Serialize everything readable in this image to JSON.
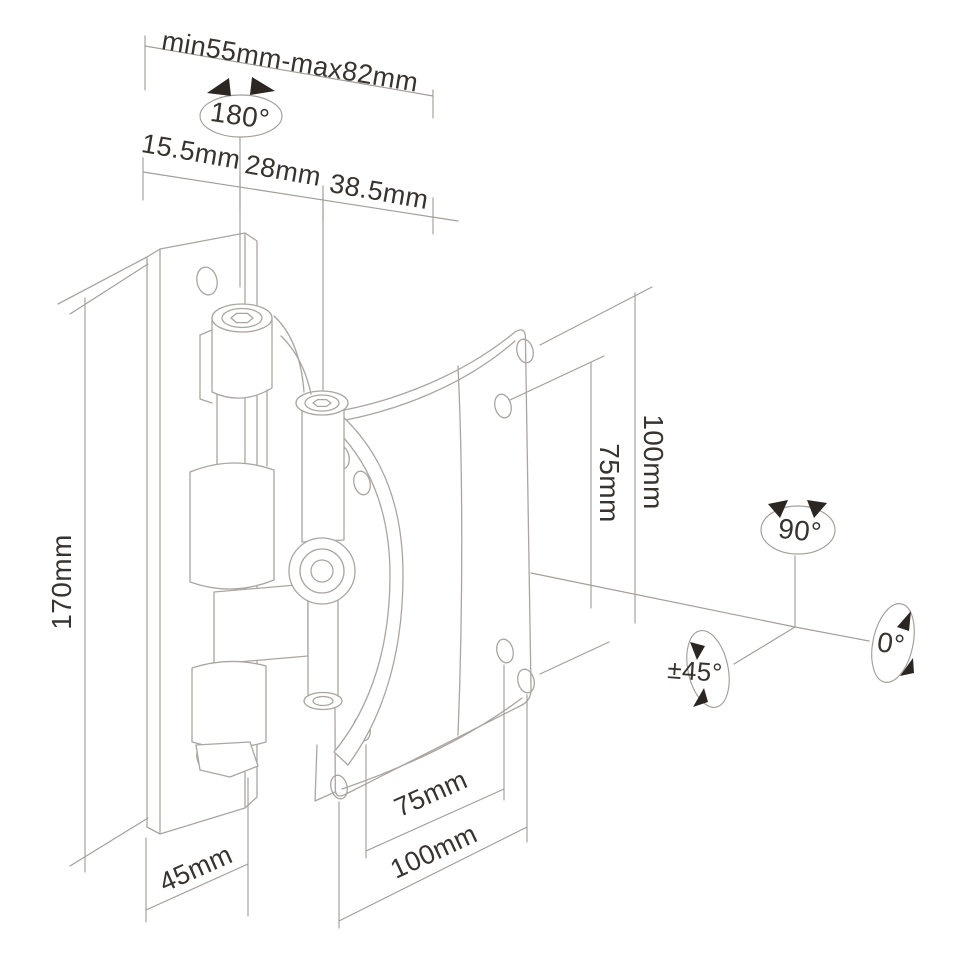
{
  "page": {
    "background": "#ffffff"
  },
  "diagram": {
    "subject": "wall-mount monitor bracket technical drawing with dimensions",
    "colors": {
      "object_line": "#aba59f",
      "dimension_line": "#a49e98",
      "text": "#38332e",
      "arrow": "#2b2621",
      "background": "#ffffff"
    },
    "labels": {
      "range_top": "min55mm-max82mm",
      "swivel_angle": "180°",
      "depth_seg_1": "15.5mm",
      "depth_seg_2": "28mm",
      "depth_seg_3": "38.5mm",
      "plate_height": "170mm",
      "vesa_vert_inner": "75mm",
      "vesa_vert_outer": "100mm",
      "rotate_portrait": "90°",
      "tilt_range": "±45°",
      "rotate_zero": "0°",
      "wall_offset": "45mm",
      "vesa_horiz_inner": "75mm",
      "vesa_horiz_outer": "100mm"
    }
  }
}
